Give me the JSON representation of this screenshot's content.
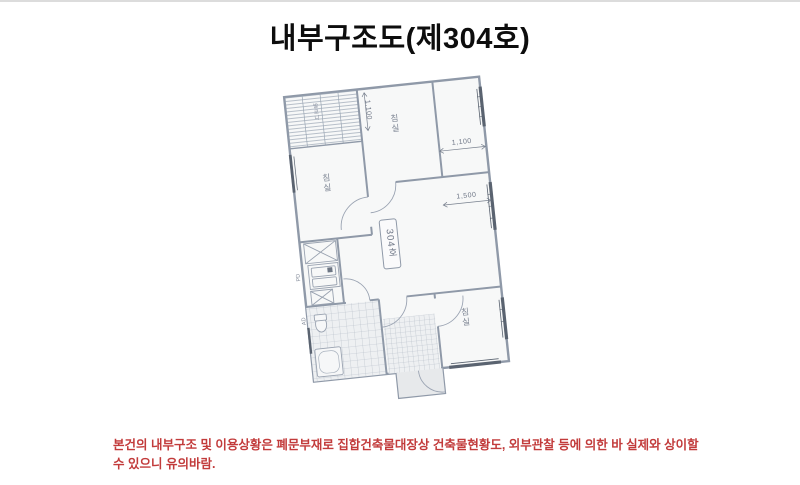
{
  "page": {
    "title": "내부구조도(제304호)"
  },
  "note": {
    "line1": "본건의 내부구조 및 이용상황은 폐문부재로 집합건축물대장상 건축물현황도, 외부관찰 등에 의한 바 실제와 상이할",
    "line2": "수 있으니 유의바람."
  },
  "floor_plan": {
    "unit_label": "304호",
    "room_labels": {
      "balcony": "발코니",
      "bedroom_left": "침실",
      "bedroom_top": "침실",
      "bedroom_bottom": "침실"
    },
    "duct_labels": {
      "pd": "PD",
      "ad": "AD"
    },
    "dimensions": {
      "top_vertical": "1,100",
      "right_upper": "1,100",
      "right_lower": "1,500"
    },
    "colors": {
      "wall_line": "#8f99a8",
      "window_line": "#5a6370",
      "note_red": "#c23b3b"
    }
  }
}
